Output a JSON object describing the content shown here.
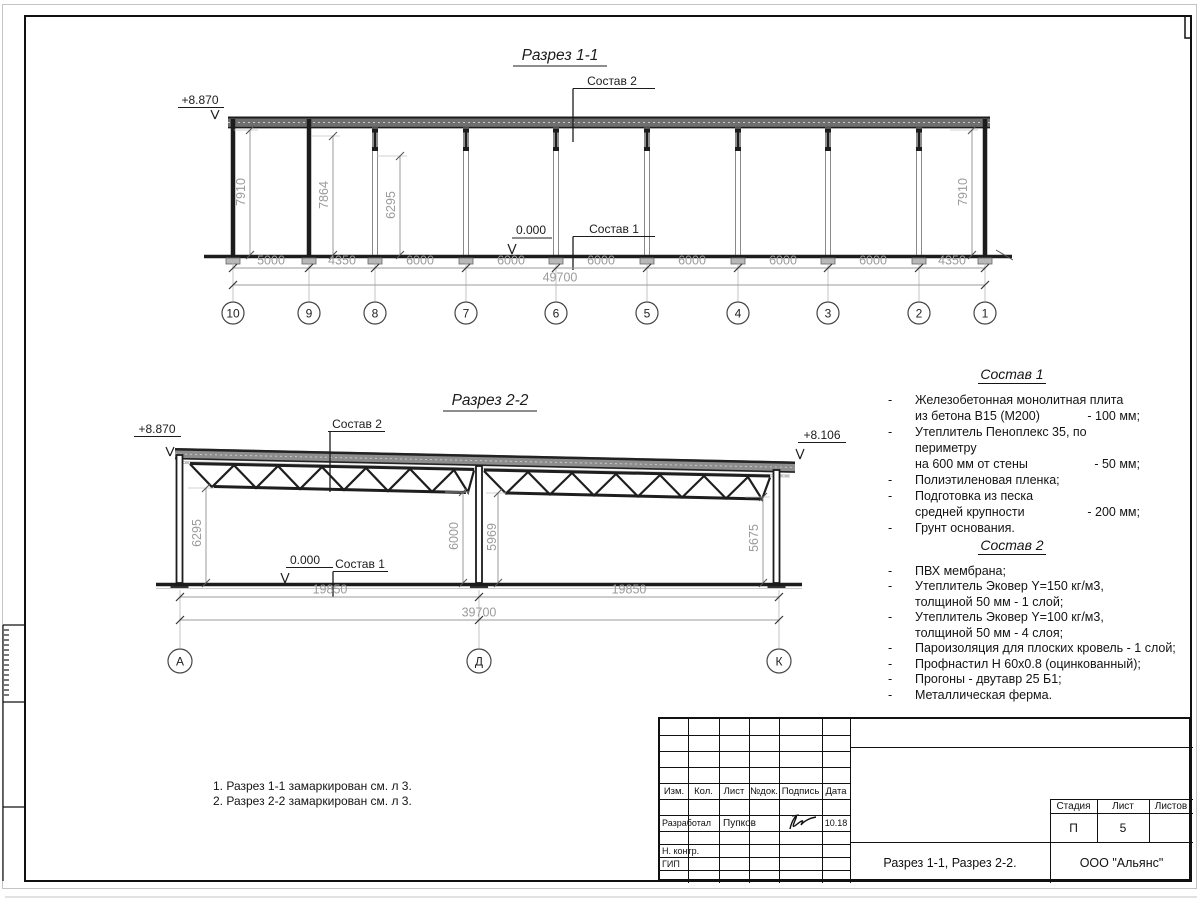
{
  "s1": {
    "title": "Разрез 1-1",
    "elev_left": "+8.870",
    "zero": "0.000",
    "leader_top": "Состав 2",
    "leader_bottom": "Состав 1",
    "vdim1": "7910",
    "vdim2": "7864",
    "vdim3": "6295",
    "vdim4": "7910",
    "dims": [
      "5000",
      "4350",
      "6000",
      "6000",
      "6000",
      "6000",
      "6000",
      "6000",
      "4350"
    ],
    "total": "49700",
    "axes": [
      "10",
      "9",
      "8",
      "7",
      "6",
      "5",
      "4",
      "3",
      "2",
      "1"
    ]
  },
  "s2": {
    "title": "Разрез 2-2",
    "elev_left": "+8.870",
    "elev_right": "+8.106",
    "zero": "0.000",
    "leader_top": "Состав 2",
    "leader_bottom": "Состав 1",
    "vdims": [
      "6295",
      "6000",
      "5969",
      "5675"
    ],
    "dims": [
      "19850",
      "19850"
    ],
    "total": "39700",
    "axes": [
      "А",
      "Д",
      "К"
    ]
  },
  "sostav1": {
    "title": "Состав 1",
    "rows": [
      {
        "b": "-",
        "t": "Железобетонная  монолитная плита",
        "v": ""
      },
      {
        "b": "",
        "t": "из бетона В15 (М200)",
        "v": "- 100 мм;"
      },
      {
        "b": "-",
        "t": "Утеплитель Пеноплекс 35, по периметру",
        "v": ""
      },
      {
        "b": "",
        "t": "на 600 мм от стены",
        "v": "- 50 мм;"
      },
      {
        "b": "-",
        "t": "Полиэтиленовая пленка;",
        "v": ""
      },
      {
        "b": "-",
        "t": "Подготовка из песка",
        "v": ""
      },
      {
        "b": "",
        "t": "средней крупности",
        "v": "- 200 мм;"
      },
      {
        "b": "-",
        "t": "Грунт основания.",
        "v": ""
      }
    ]
  },
  "sostav2": {
    "title": "Состав 2",
    "rows": [
      {
        "b": "-",
        "t": "ПВХ мембрана;",
        "v": ""
      },
      {
        "b": "-",
        "t": "Утеплитель Эковер Y=150 кг/м3,",
        "v": ""
      },
      {
        "b": "",
        "t": "толщиной 50 мм - 1 слой;",
        "v": ""
      },
      {
        "b": "-",
        "t": "Утеплитель Эковер Y=100 кг/м3,",
        "v": ""
      },
      {
        "b": "",
        "t": "толщиной 50 мм - 4 слоя;",
        "v": ""
      },
      {
        "b": "-",
        "t": "Пароизоляция для плоских кровель - 1 слой;",
        "v": ""
      },
      {
        "b": "-",
        "t": "Профнастил Н 60х0.8 (оцинкованный);",
        "v": ""
      },
      {
        "b": "-",
        "t": "Прогоны - двутавр 25 Б1;",
        "v": ""
      },
      {
        "b": "-",
        "t": "Металлическая ферма.",
        "v": ""
      }
    ]
  },
  "notes": [
    "1. Разрез 1-1 замаркирован см. л 3.",
    "2. Разрез 2-2 замаркирован см. л 3."
  ],
  "stamp": {
    "cols": [
      "Изм.",
      "Кол.",
      "Лист",
      "№док.",
      "Подпись",
      "Дата"
    ],
    "developer_label": "Разработал",
    "developer": "Пупков",
    "date": "10.18",
    "ncontrol_label": "Н. контр.",
    "gip_label": "ГИП",
    "stage_label": "Стадия",
    "sheet_label": "Лист",
    "sheets_label": "Листов",
    "stage": "П",
    "sheet": "5",
    "title": "Разрез 1-1, Разрез 2-2.",
    "company": "ООО \"Альянс\""
  }
}
